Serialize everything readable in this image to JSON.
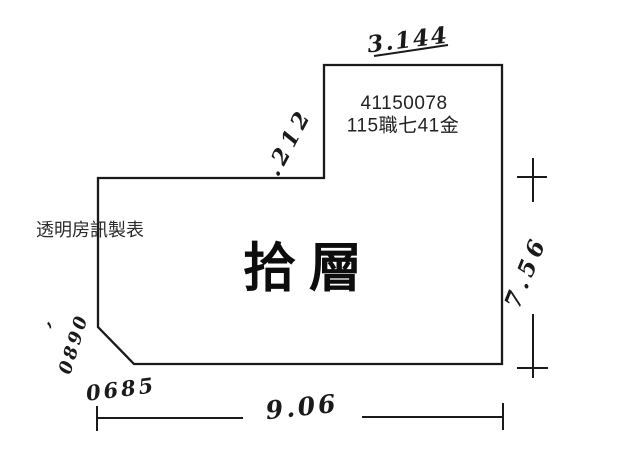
{
  "colors": {
    "ink": "#1a1a1a",
    "paper": "#ffffff",
    "print": "#222222"
  },
  "plan": {
    "floor_label": "拾層",
    "unit_number": "41150078",
    "unit_code": "115職七41金",
    "maker_label": "透明房訊製表"
  },
  "dimensions": {
    "top": "3.144",
    "upper_left": ".212",
    "right": "7.56",
    "bottom": "9.06",
    "left_side": "0890",
    "chamfer": "0685",
    "stray_mark": ","
  }
}
